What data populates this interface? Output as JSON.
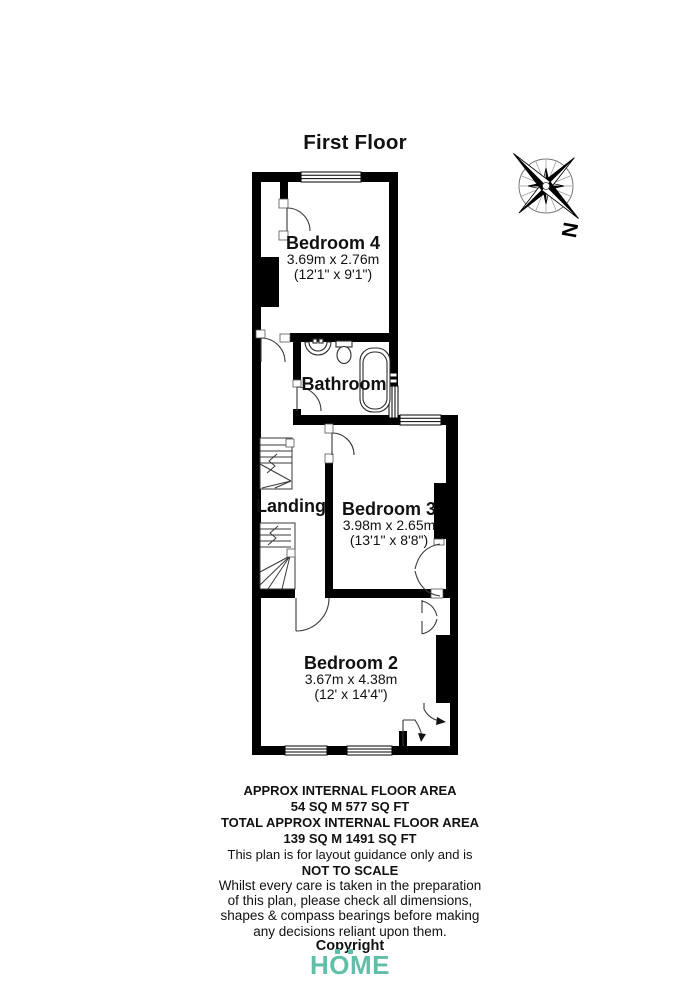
{
  "title": "First Floor",
  "compass": {
    "label": "N"
  },
  "rooms": {
    "bedroom4": {
      "name": "Bedroom 4",
      "metric": "3.69m x 2.76m",
      "imperial": "(12'1\" x 9'1\")"
    },
    "bathroom": {
      "name": "Bathroom"
    },
    "landing": {
      "name": "Landing"
    },
    "bedroom3": {
      "name": "Bedroom 3",
      "metric": "3.98m x 2.65m",
      "imperial": "(13'1\" x 8'8\")"
    },
    "bedroom2": {
      "name": "Bedroom 2",
      "metric": "3.67m x 4.38m",
      "imperial": "(12' x 14'4\")"
    }
  },
  "footer": {
    "area_label": "APPROX INTERNAL FLOOR AREA",
    "area_value": "54 SQ M 577 SQ FT",
    "total_label": "TOTAL APPROX INTERNAL FLOOR AREA",
    "total_value": "139 SQ M 1491 SQ FT",
    "guidance": "This plan is for layout guidance only and is",
    "scale": "NOT TO SCALE",
    "disclaimer": [
      "Whilst every care is taken in the preparation",
      "of this plan, please check all dimensions,",
      "shapes & compass bearings before making",
      "any decisions reliant upon them."
    ],
    "copyright": "Copyright",
    "logo": "HOME"
  },
  "colors": {
    "wall": "#000000",
    "line": "#3a3a3a",
    "logo": "#63BEA9"
  }
}
